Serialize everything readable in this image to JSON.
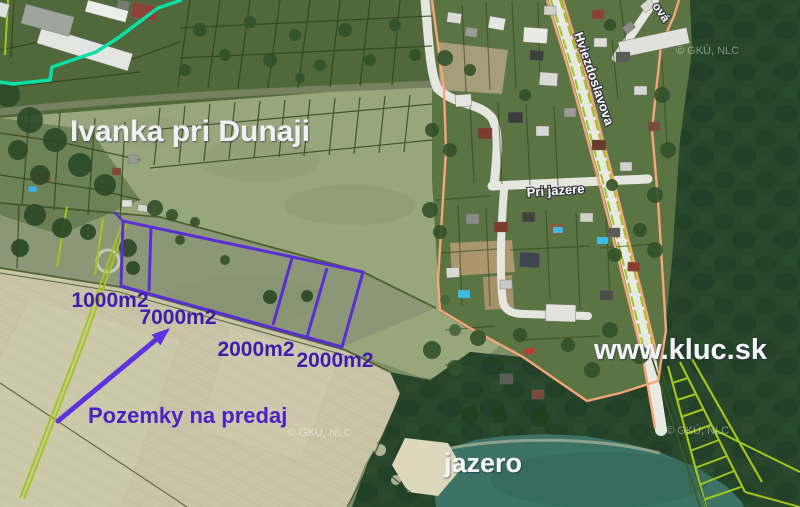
{
  "map": {
    "town_label": "Ivanka pri Dunaji",
    "lake_label": "jazero",
    "website_label": "www.kluc.sk",
    "promo_label": "Pozemky na predaj",
    "street_main": "Hviezdoslavova",
    "street_lake": "Pri jazere",
    "street_partial": "ová",
    "plots": [
      {
        "area_label": "1000m2"
      },
      {
        "area_label": "7000m2"
      },
      {
        "area_label": "2000m2"
      },
      {
        "area_label": "2000m2"
      }
    ],
    "watermark": "© GKÚ, NLC",
    "colors": {
      "plot_outline": "#5a2ed2",
      "plot_label": "#3e1cae",
      "promo_text": "#4a22c6",
      "arrow": "#5d33dd",
      "boundary_orange": "#f3a677",
      "parcel_chartreuse": "#a4c41e",
      "utility_cyan": "#0ae0a6",
      "label_white": "#f0f1f4"
    }
  }
}
